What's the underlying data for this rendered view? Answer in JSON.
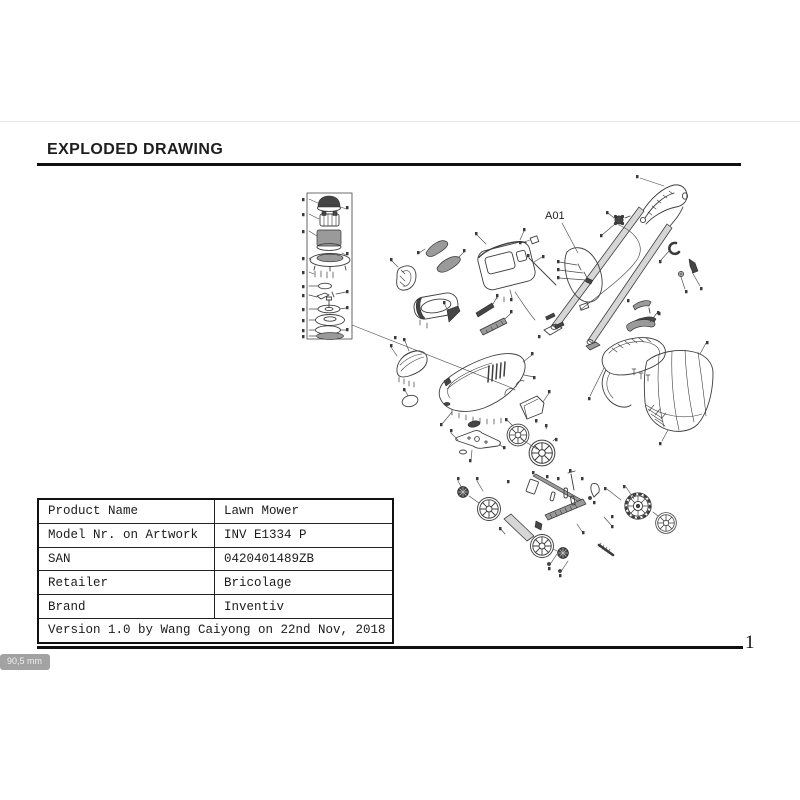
{
  "page": {
    "title": "EXPLODED DRAWING",
    "page_number": "1",
    "measure_badge": "90,5 mm"
  },
  "diagram": {
    "callout_label": "A01"
  },
  "table": {
    "rows": [
      {
        "label": "Product Name",
        "value": "Lawn Mower"
      },
      {
        "label": "Model Nr. on Artwork",
        "value": "INV E1334 P"
      },
      {
        "label": "SAN",
        "value": "0420401489ZB"
      },
      {
        "label": "Retailer",
        "value": "Bricolage"
      },
      {
        "label": "Brand",
        "value": "Inventiv"
      }
    ],
    "footer": "Version 1.0 by Wang Caiyong on 22nd Nov, 2018"
  },
  "colors": {
    "rule": "#101010",
    "badge_bg": "#a2a2a2",
    "line_art": "#3e3e3e"
  }
}
